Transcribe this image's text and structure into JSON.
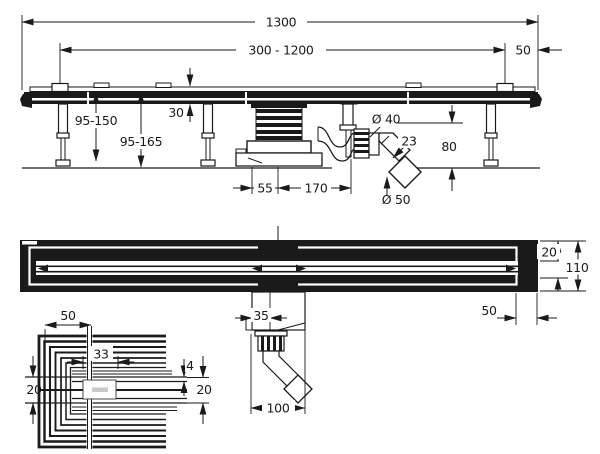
{
  "meta": {
    "background_color": "#ffffff",
    "line_color": "#1a1a1a",
    "drawing_type": "technical installation drawing"
  },
  "side_view": {
    "overall_length": "1300",
    "adjustable_range": "300 - 1200",
    "end_distance": "50",
    "leg_height_range": "95-150",
    "install_height_range": "95-165",
    "channel_body_height": "30",
    "outlet_diameter": "Ø 40",
    "pipe_outside": "23",
    "outlet_axis_height": "80",
    "trap_offset": "55",
    "trap_length": "170",
    "pipe_diameter": "Ø 50"
  },
  "plan_view": {
    "frame_border": "20",
    "channel_width": "110",
    "end_cap_length": "50",
    "outlet_offset": "35",
    "outlet_length": "100"
  },
  "corner_detail": {
    "corner_width": "50",
    "logo_plate_width": "33",
    "slot_gap": "4",
    "band_left": "20",
    "band_right": "20"
  }
}
